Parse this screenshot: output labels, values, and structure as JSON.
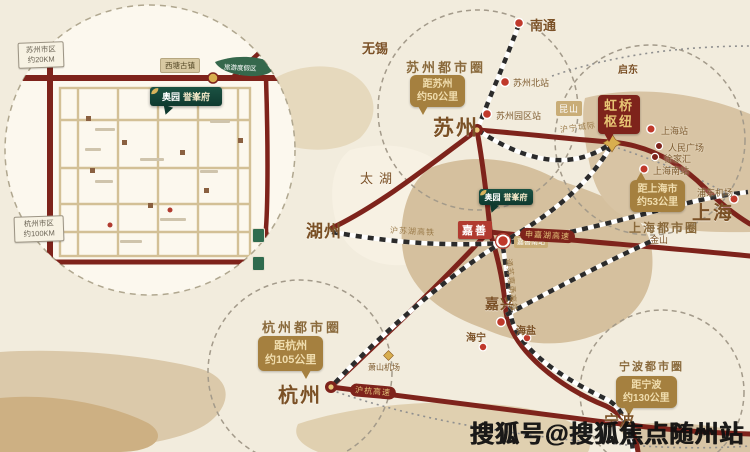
{
  "watermark": "搜狐号@搜狐焦点随州站",
  "project": {
    "brand": "奥园",
    "name": "誉峯府",
    "town": "嘉善",
    "station": "嘉善南站"
  },
  "hub": {
    "line1": "虹桥",
    "line2": "枢纽"
  },
  "metro_circles": {
    "suzhou": "苏州都市圈",
    "shanghai": "上海都市圈",
    "hangzhou": "杭州都市圈",
    "ningbo": "宁波都市圈"
  },
  "callouts": {
    "suzhou": {
      "line1": "距苏州",
      "line2": "约50公里"
    },
    "shanghai": {
      "line1": "距上海市",
      "line2": "约53公里"
    },
    "hangzhou": {
      "line1": "距杭州",
      "line2": "约105公里"
    },
    "ningbo": {
      "line1": "距宁波",
      "line2": "约130公里"
    }
  },
  "cities": {
    "suzhou": "苏州",
    "shanghai": "上海",
    "hangzhou": "杭州",
    "huzhou": "湖州",
    "jiaxing": "嘉兴",
    "ningbo": "宁波",
    "wuxi": "无锡",
    "nantong": "南通",
    "kunshan": "昆山",
    "qidong": "启东",
    "jinshan": "金山",
    "haining": "海宁",
    "haiyan": "海盐",
    "taihu_lake": "太湖"
  },
  "stations": {
    "suzhou_north": "苏州北站",
    "suzhou_park": "苏州园区站",
    "shanghai_main": "上海站",
    "peoples_square": "人民广场",
    "xujiahui": "徐家汇",
    "shanghai_south": "上海南站",
    "pudong_airport": "浦东机场",
    "xiaoshan_airport": "萧山机场"
  },
  "rail_labels": {
    "huning": "沪宁城际",
    "husuhu": "沪苏湖高铁",
    "tongsujiayong": "通苏嘉甬高铁"
  },
  "road_labels": {
    "huhang": "沪杭高速",
    "shenjiahu": "申嘉湖高速"
  },
  "inset": {
    "sign_top": {
      "line1": "苏州市区",
      "line2": "约20KM"
    },
    "sign_bottom": {
      "line1": "杭州市区",
      "line2": "约100KM"
    },
    "xitang_tag": "西塘古镇",
    "park_tag": "旅游度假区",
    "logo_brand": "奥园",
    "logo_name": "誉峯府"
  },
  "colors": {
    "background": "#f2ecdd",
    "land": "#d5c09e",
    "road": "#7e231b",
    "callout_bg": "#a5803f",
    "callout_text": "#f0ddae",
    "brand_green": "#15453a",
    "brand_gold": "#d8b35c",
    "town_red": "#b13b30",
    "label_brown": "#8a6a3c"
  }
}
